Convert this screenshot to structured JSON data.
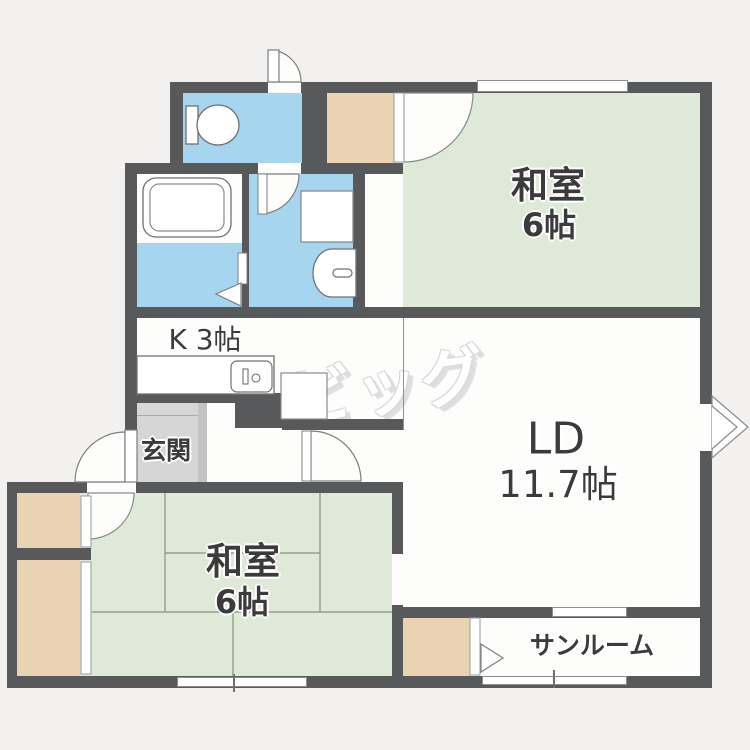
{
  "title": "apartment-floor-plan",
  "watermark": {
    "text": "ビッグ"
  },
  "rooms": {
    "washitsu_top": {
      "label": "和室",
      "size": "6帖"
    },
    "ld": {
      "label": "LD",
      "size": "11.7帖"
    },
    "kitchen": {
      "label": "K 3帖"
    },
    "genkan": {
      "label": "玄関"
    },
    "washitsu_bottom": {
      "label": "和室",
      "size": "6帖"
    },
    "sunroom": {
      "label": "サンルーム"
    }
  },
  "fixtures": [
    "toilet",
    "bathtub",
    "washing-machine",
    "washbasin",
    "kitchen-sink",
    "refrigerator-space",
    "bay-window"
  ],
  "colors": {
    "wall": "#58595b",
    "wet_area_floor": "#a6d5f0",
    "tatami_floor": "#dfe9d8",
    "closet": "#e9d3b3",
    "genkan_floor": "#d6d6d6",
    "room_floor": "#fdfdfc",
    "background": "#f2f1ef",
    "label_text": "#3b3b3b"
  }
}
